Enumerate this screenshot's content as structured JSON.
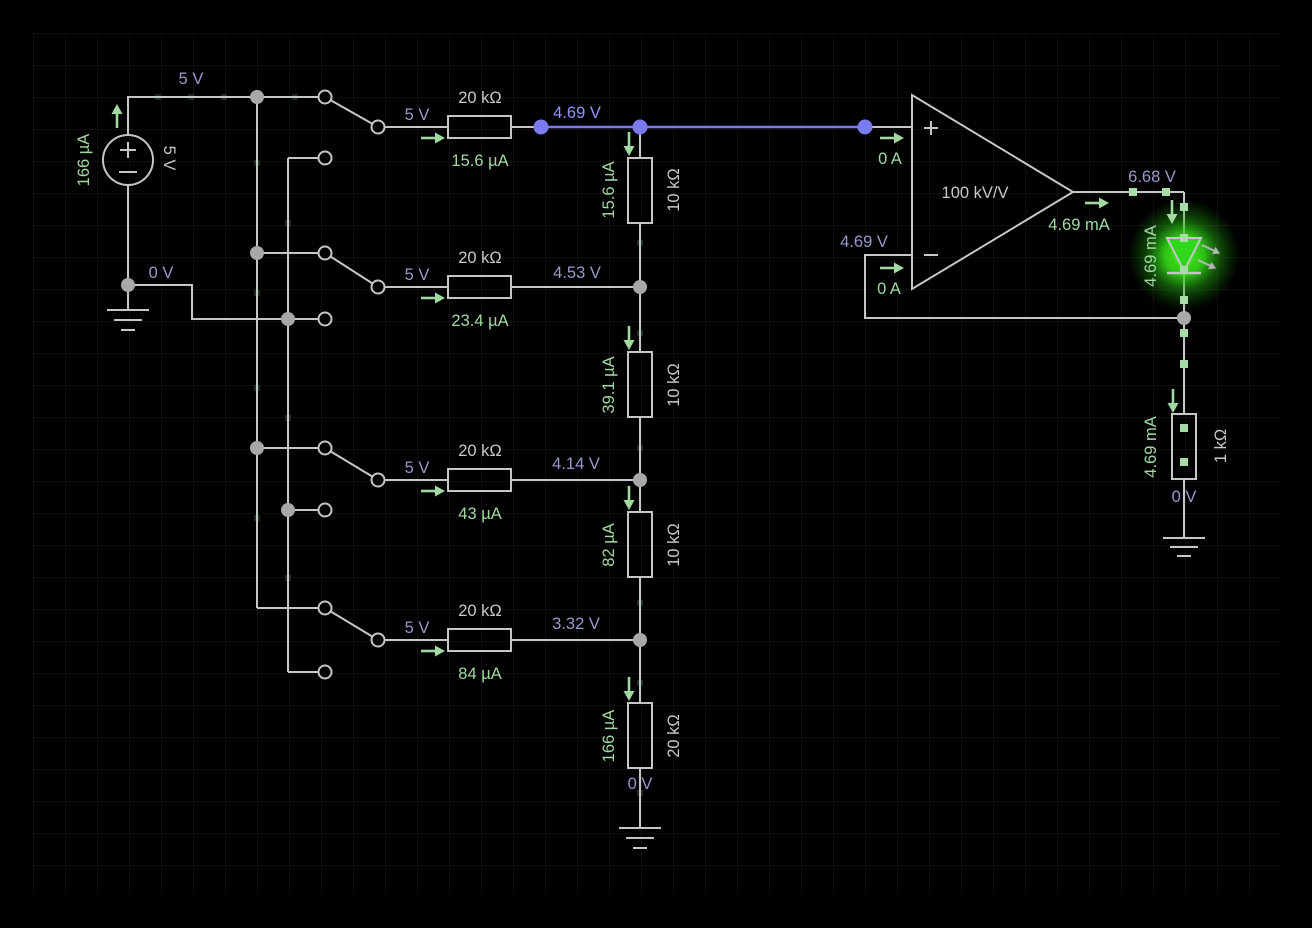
{
  "app": {
    "name": "circuit-simulator-canvas"
  },
  "colors": {
    "background": "#000000",
    "grid_line": "#1b1d1b",
    "wire": "#c6c6c6",
    "selected_wire": "#7b7bf0",
    "selected_label": "#9294ff",
    "voltage_label": "#9898cb",
    "current_label": "#a2d9a2",
    "component_label": "#c9c9c9",
    "node_dot": "#a8a8a8",
    "current_dot": "#aadcaa",
    "led_green": "#2ed61c"
  },
  "nets": {
    "top_rail_voltage": "5 V",
    "ground_rail_voltage": "0 V"
  },
  "source": {
    "voltage": "5 V",
    "current": "166 µA"
  },
  "dac_rows": [
    {
      "input_voltage": "5 V",
      "resistance": "20 kΩ",
      "current": "15.6 µA",
      "output_voltage": "4.69 V"
    },
    {
      "input_voltage": "5 V",
      "resistance": "20 kΩ",
      "current": "23.4 µA",
      "output_voltage": "4.53 V"
    },
    {
      "input_voltage": "5 V",
      "resistance": "20 kΩ",
      "current": "43 µA",
      "output_voltage": "4.14 V"
    },
    {
      "input_voltage": "5 V",
      "resistance": "20 kΩ",
      "current": "84 µA",
      "output_voltage": "3.32 V"
    }
  ],
  "ladder": {
    "resistors": [
      {
        "resistance": "10 kΩ",
        "current": "15.6 µA"
      },
      {
        "resistance": "10 kΩ",
        "current": "39.1 µA"
      },
      {
        "resistance": "10 kΩ",
        "current": "82 µA"
      },
      {
        "resistance": "20 kΩ",
        "current": "166 µA"
      }
    ],
    "bottom_voltage": "0 V"
  },
  "opamp": {
    "gain": "100 kV/V",
    "noninverting_current": "0 A",
    "inverting_current": "0 A",
    "inverting_voltage": "4.69 V",
    "output_voltage": "6.68 V",
    "output_current": "4.69 mA"
  },
  "led": {
    "current": "4.69 mA"
  },
  "load_resistor": {
    "resistance": "1 kΩ",
    "current": "4.69 mA",
    "bottom_voltage": "0 V"
  }
}
